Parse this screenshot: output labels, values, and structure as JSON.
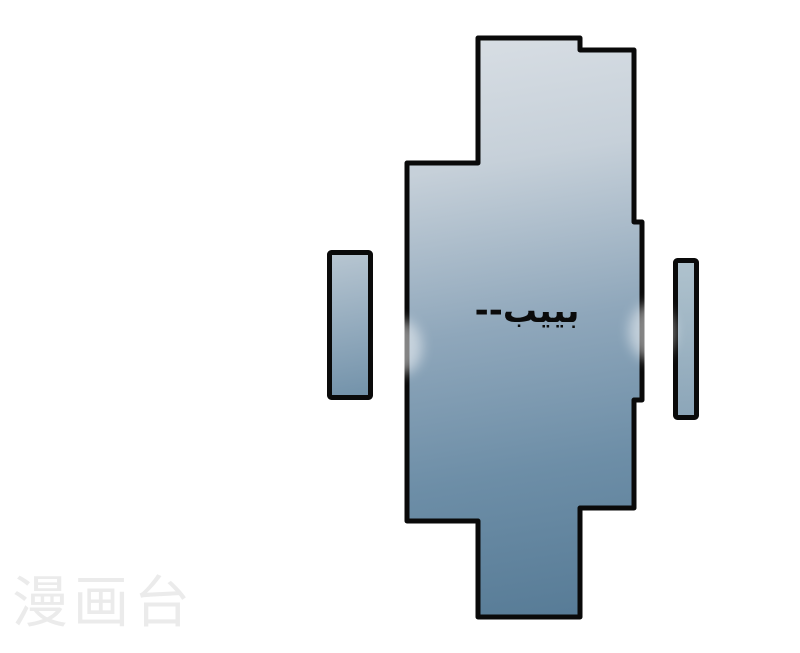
{
  "page": {
    "background_color": "#ffffff",
    "width": 800,
    "height": 653
  },
  "panel": {
    "sfx_text": "بييب--",
    "border_color": "#0a0a0a",
    "fill_gradient_top": "#d8dee4",
    "fill_gradient_bottom": "#587c97"
  },
  "side_bars": {
    "left": {
      "fill_top": "#b9c7d2",
      "fill_bottom": "#7191a9",
      "border_color": "#0a0a0a"
    },
    "right": {
      "fill_top": "#b0c3ce",
      "fill_bottom": "#8ba5b8",
      "border_color": "#0a0a0a"
    }
  },
  "watermark": {
    "text": "漫画台",
    "color": "#ebebeb"
  }
}
